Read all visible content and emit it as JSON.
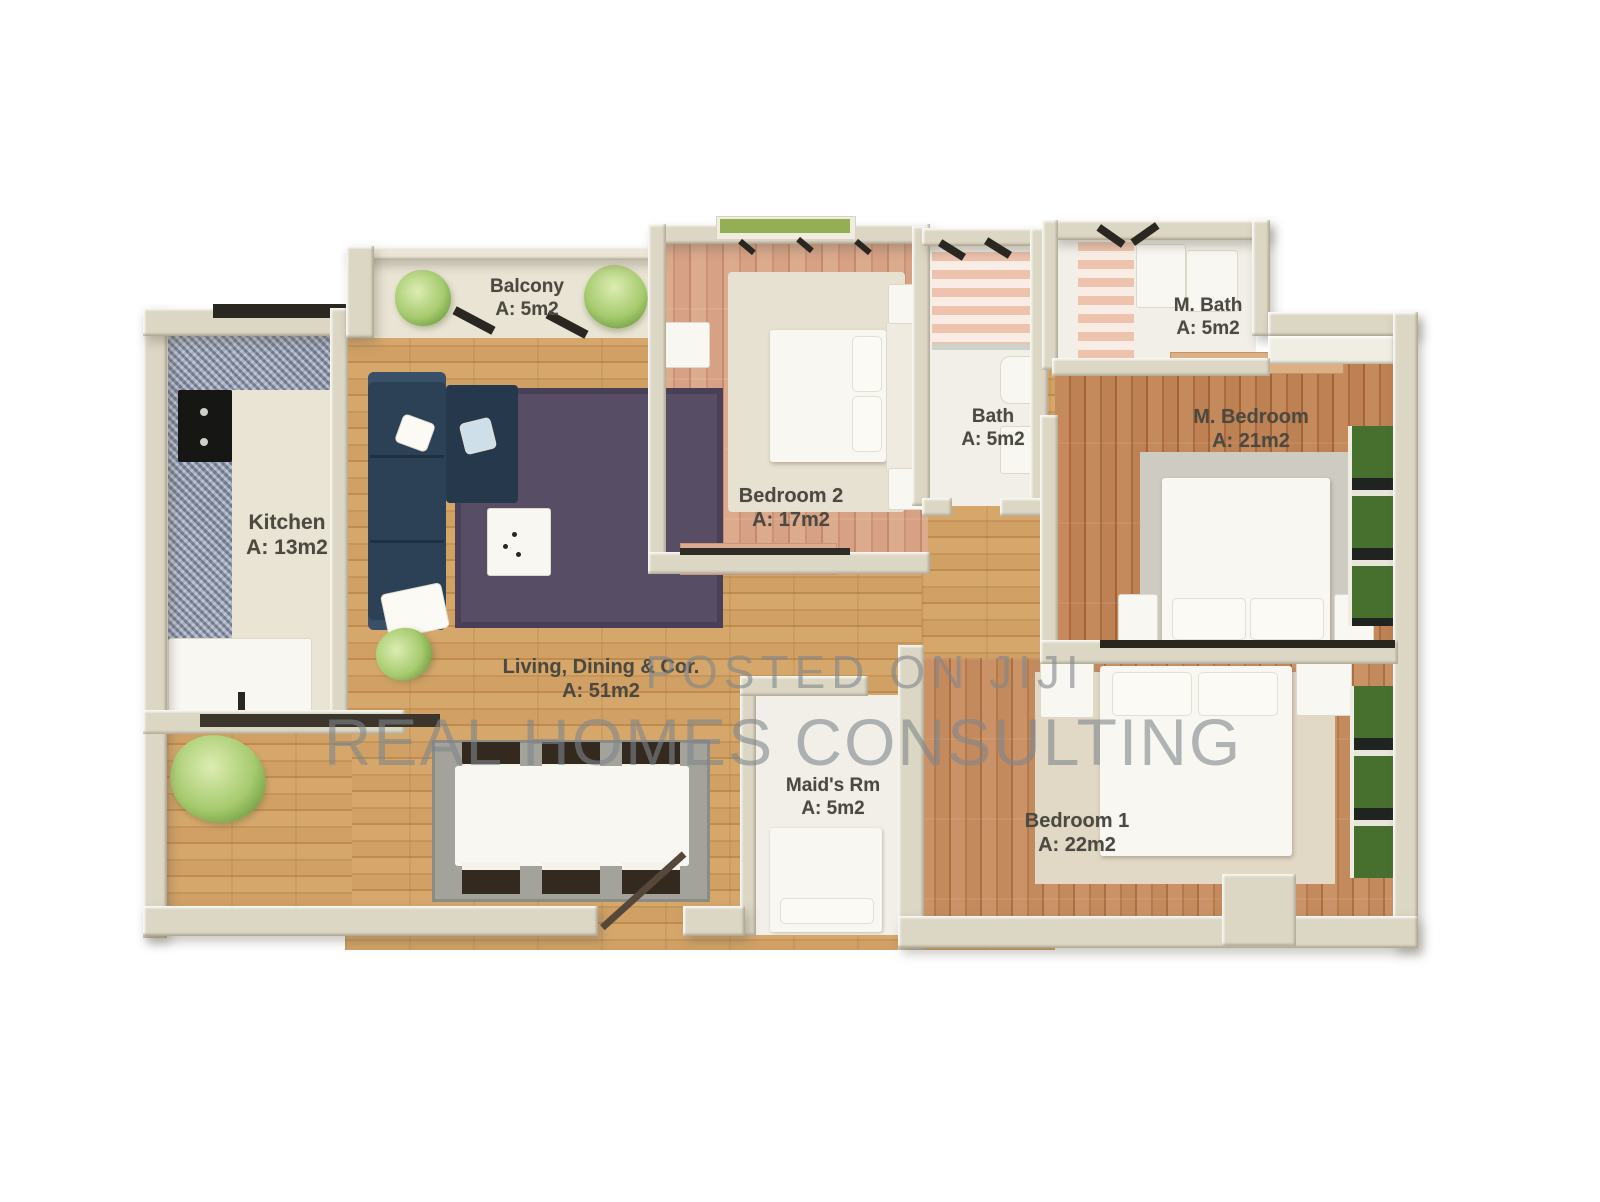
{
  "plan_title": "Apartment floor plan",
  "rooms": {
    "balcony": {
      "name": "Balcony",
      "area": "A: 5m2"
    },
    "kitchen": {
      "name": "Kitchen",
      "area": "A: 13m2"
    },
    "bedroom2": {
      "name": "Bedroom 2",
      "area": "A: 17m2"
    },
    "bath": {
      "name": "Bath",
      "area": "A: 5m2"
    },
    "m_bath": {
      "name": "M. Bath",
      "area": "A: 5m2"
    },
    "m_bedroom": {
      "name": "M. Bedroom",
      "area": "A: 21m2"
    },
    "living": {
      "name": "Living, Dining & Cor.",
      "area": "A: 51m2"
    },
    "maids_rm": {
      "name": "Maid's Rm",
      "area": "A: 5m2"
    },
    "bedroom1": {
      "name": "Bedroom 1",
      "area": "A: 22m2"
    }
  },
  "watermark": {
    "line1": "POSTED ON JIJI",
    "line2": "REAL HOMES CONSULTING"
  },
  "colors": {
    "wall": "#dcd6c4",
    "oak_floor": "#d0a064",
    "salmon_floor": "#d6a185",
    "red_floor": "#b37a4a",
    "rug_purple": "#574e66",
    "sofa_navy": "#2d4156",
    "granite": "#99a2b5",
    "plant_green": "#a6ca6e",
    "label_text": "#4b4940",
    "watermark_gray": "#7e868c"
  }
}
